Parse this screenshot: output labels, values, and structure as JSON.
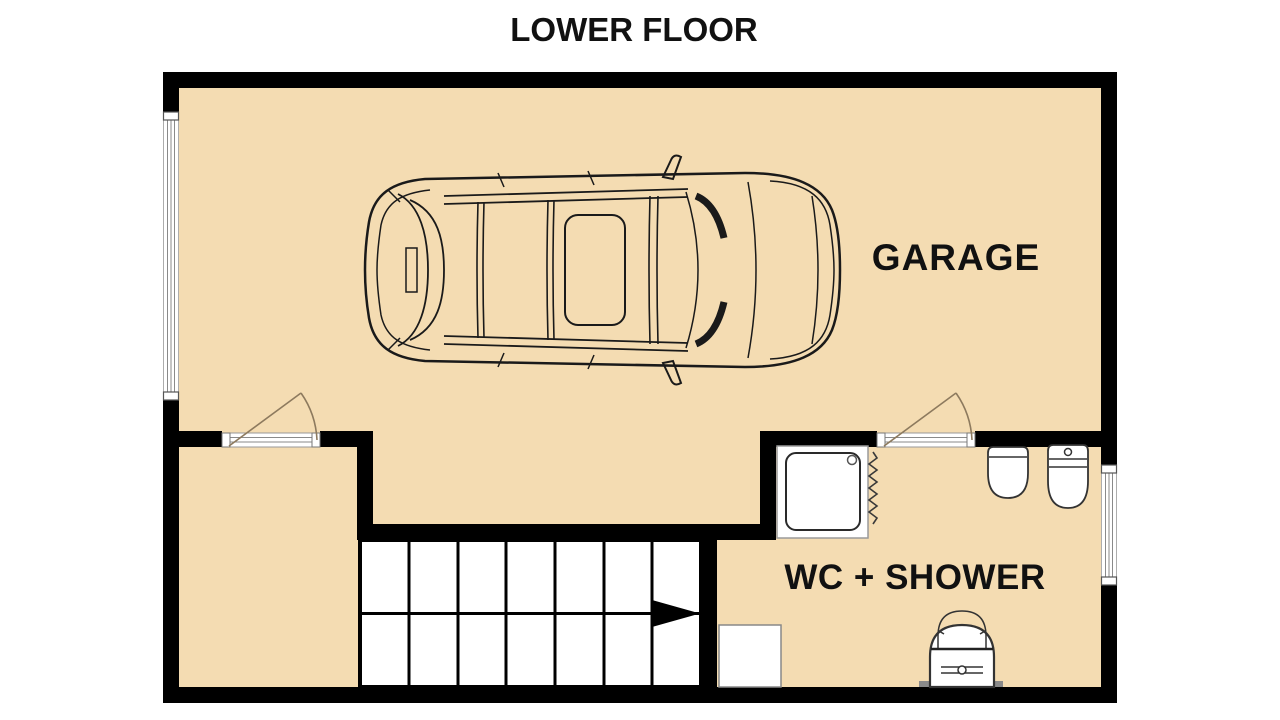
{
  "title": "LOWER FLOOR",
  "rooms": {
    "garage": {
      "label": "GARAGE"
    },
    "wc_shower": {
      "label": "WC + SHOWER"
    }
  },
  "stairs": {
    "columns": 7,
    "rows": 2,
    "direction_arrow": "right"
  },
  "fixtures": {
    "garage": [
      "car-top-view"
    ],
    "wc_shower": [
      "shower-tray",
      "shower-hose",
      "wall-hung-wc",
      "toilet-with-cistern",
      "washbasin",
      "washing-machine"
    ]
  },
  "openings": {
    "doors": [
      "storage-room-door",
      "wc-shower-door"
    ],
    "windows": [
      "left-wall-window",
      "right-wall-window"
    ]
  },
  "colors": {
    "floor_fill": "#f4dcb2",
    "wall": "#000000",
    "door_swing": "#8d7a5e",
    "label_text": "#111111",
    "fixture_outline": "#333333"
  }
}
